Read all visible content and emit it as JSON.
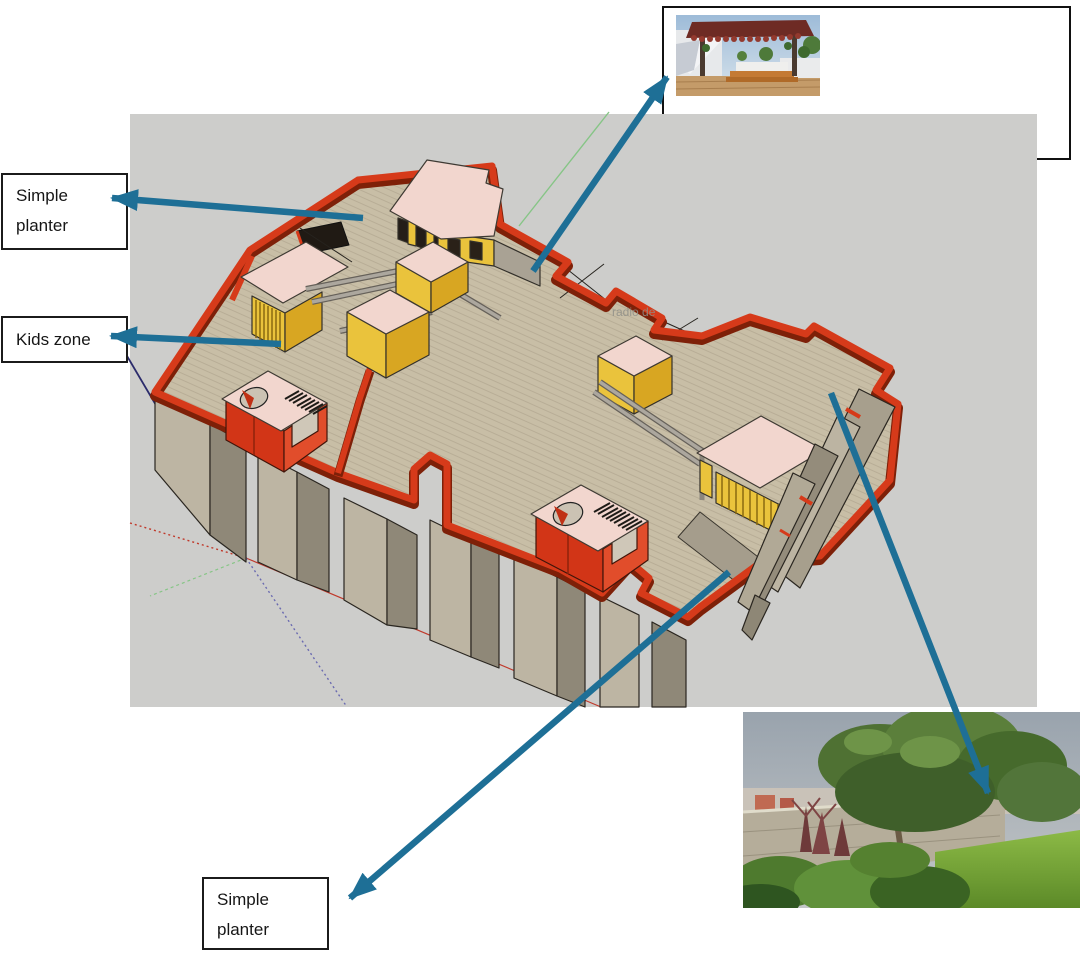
{
  "page": {
    "width": 1080,
    "height": 959,
    "background": "#ffffff"
  },
  "viewport": {
    "background": "#CDCDCB",
    "watermark": "radio de"
  },
  "annotations": {
    "simple_planter_top": {
      "line1": "Simple",
      "line2": "planter"
    },
    "kids_zone": {
      "label": "Kids zone"
    },
    "simple_planter_bottom": {
      "line1": "Simple",
      "line2": "planter"
    }
  },
  "arrows": {
    "color": "#1E6F96",
    "items": [
      {
        "name": "arrow-to-pergola-photo"
      },
      {
        "name": "arrow-simple-planter-top"
      },
      {
        "name": "arrow-kids-zone"
      },
      {
        "name": "arrow-simple-planter-bottom"
      },
      {
        "name": "arrow-to-garden-photo"
      }
    ]
  },
  "insets": {
    "top": {
      "name": "pergola-seating-photo"
    },
    "bottom": {
      "name": "rooftop-garden-photo"
    }
  },
  "colors": {
    "viewport_gray": "#CDCDCB",
    "parapet_red": "#D63A1A",
    "parapet_red_dark": "#7E2008",
    "deck_tan": "#C8BEA6",
    "wall_gray_light": "#BDB5A3",
    "wall_gray_dark": "#8F8878",
    "pergola_yellow": "#EAC33C",
    "pergola_yellow_dark": "#D8A622",
    "roof_pink": "#F2D6CE",
    "arrow_teal": "#1E6F96"
  }
}
